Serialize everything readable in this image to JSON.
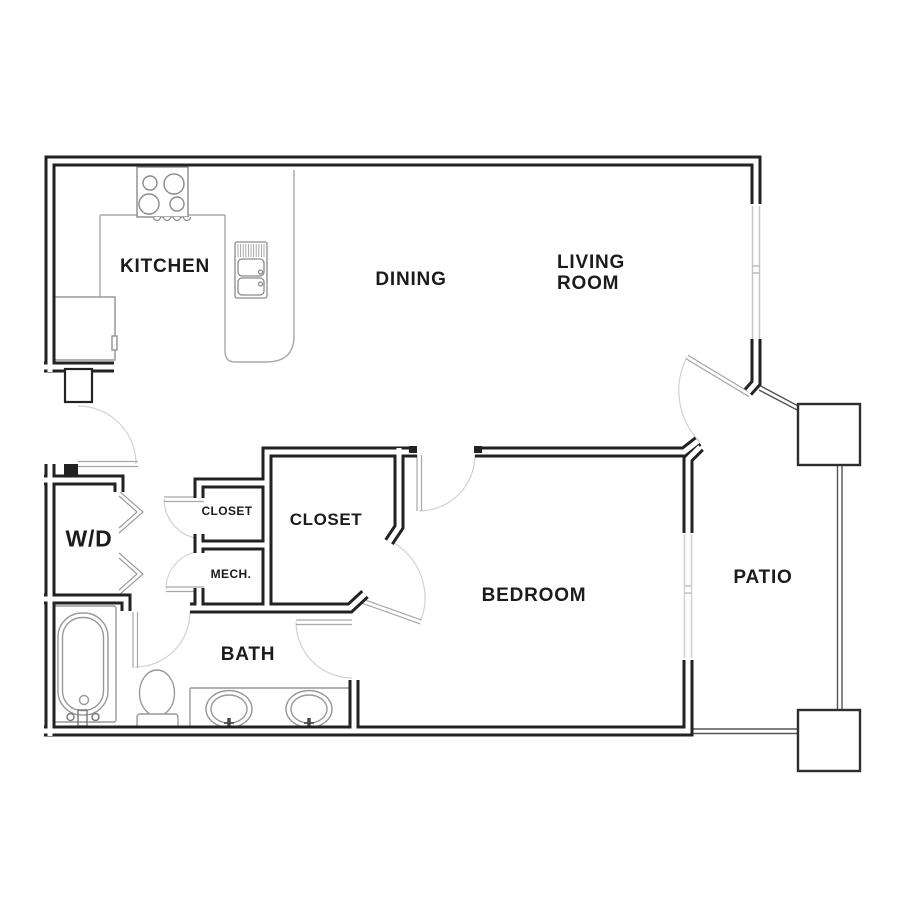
{
  "rooms": {
    "kitchen": "KITCHEN",
    "dining": "DINING",
    "living_room_line1": "LIVING",
    "living_room_line2": "ROOM",
    "washer_dryer": "W/D",
    "closet_small": "CLOSET",
    "closet_walk_in": "CLOSET",
    "mechanical": "MECH.",
    "bath": "BATH",
    "bedroom": "BEDROOM",
    "patio": "PATIO"
  },
  "fixtures": {
    "stove": "4-burner-stove",
    "kitchen_sink": "double-basin-sink",
    "refrigerator": "refrigerator",
    "bathtub": "bathtub",
    "toilet": "toilet",
    "vanity": "double-sink-vanity",
    "doors": "hinged-door-arcs",
    "wd_doors": "bifold-doors",
    "windows": "wall-windows",
    "patio_columns": "square-pillars-with-railing"
  },
  "colors": {
    "wall": "#222222",
    "background": "#ffffff",
    "fixture_line": "#999999",
    "window_line": "#c6c6c6",
    "door_arc": "#d2d2d2",
    "label_text": "#1c1c1c"
  }
}
